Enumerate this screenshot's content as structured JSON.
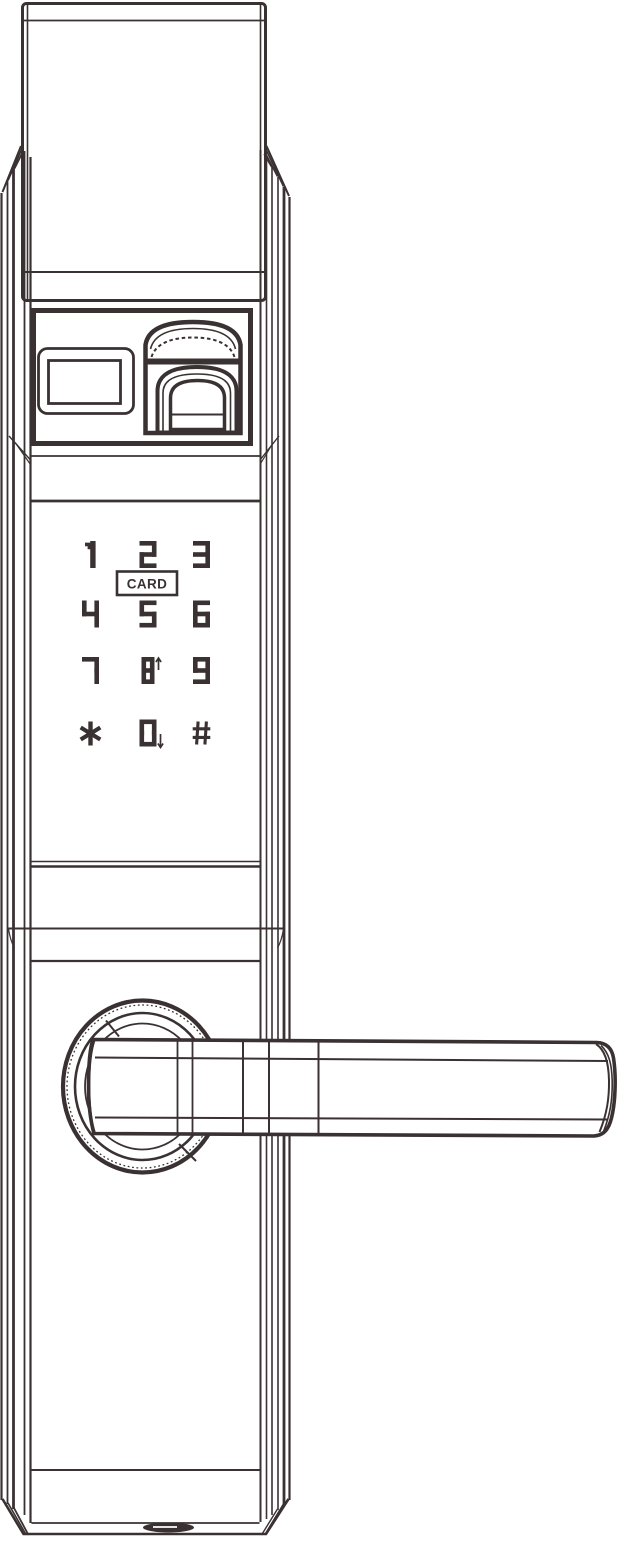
{
  "drawing": {
    "subject": "smart-door-lock-front-line-drawing"
  },
  "colors": {
    "line": "#3a3133",
    "background": "#ffffff"
  },
  "keypad": {
    "rows": [
      [
        "1",
        "2",
        "3"
      ],
      [
        "4",
        "5",
        "6"
      ],
      [
        "7",
        "8",
        "9"
      ],
      [
        "*",
        "0",
        "#"
      ]
    ],
    "card_label": "CARD",
    "key_annotations": {
      "8": "up-arrow",
      "0": "down-arrow"
    }
  },
  "components": [
    "top-cover-plate",
    "lock-body",
    "fingerprint-panel",
    "display-window",
    "fingerprint-scanner",
    "numeric-keypad",
    "card-reader-badge",
    "door-handle",
    "handle-rosette",
    "bottom-port"
  ]
}
